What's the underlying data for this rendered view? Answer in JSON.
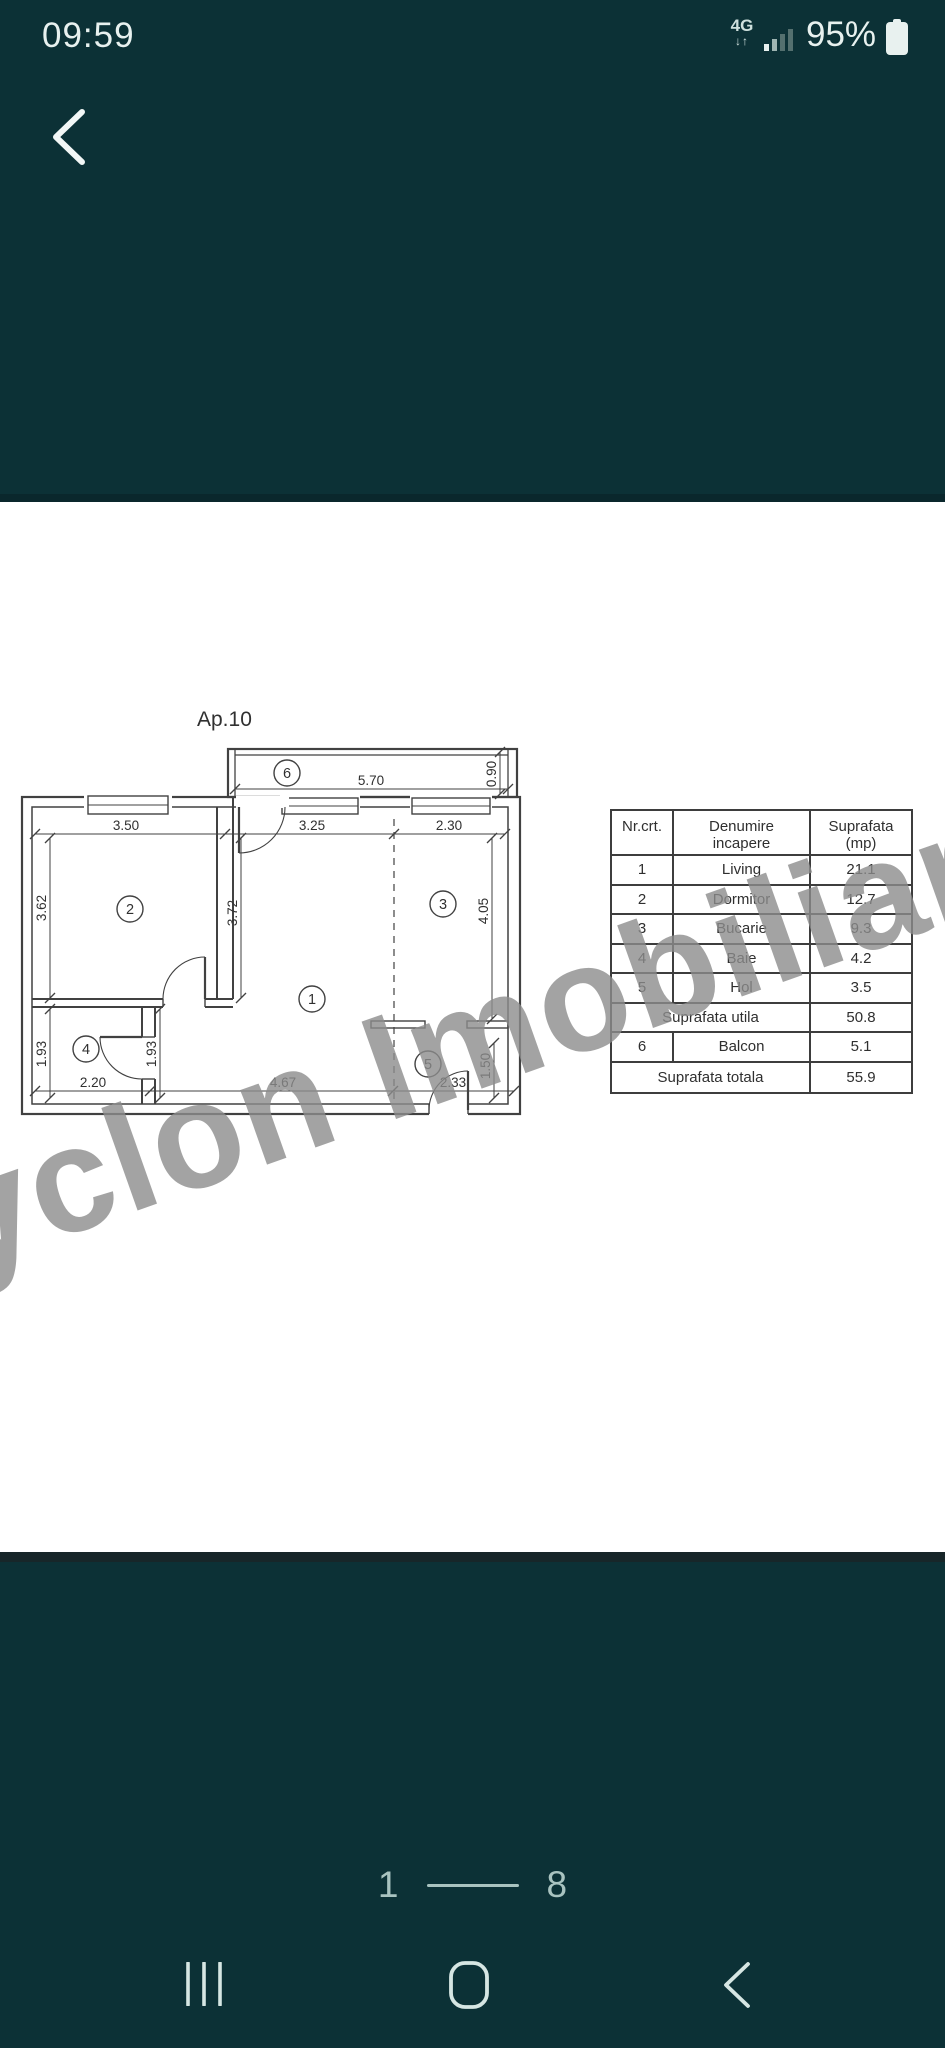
{
  "status_bar": {
    "time": "09:59",
    "network": "4G",
    "arrows": "↓↑",
    "battery_percent": "95%"
  },
  "photo": {
    "floor_plan": {
      "title": "Ap.10",
      "rooms": [
        "1",
        "2",
        "3",
        "4",
        "5",
        "6"
      ],
      "dims": {
        "balcony_width": "5.70",
        "balcony_depth": "0.90",
        "top_left": "3.50",
        "top_mid": "3.25",
        "top_right": "2.30",
        "left_upper": "3.62",
        "mid_vert": "3.72",
        "right_upper": "4.05",
        "left_lower": "1.93",
        "mid_lower": "1.93",
        "right_lower": "1.50",
        "bottom_left": "2.20",
        "bottom_mid": "4.67",
        "bottom_right": "2.33"
      }
    },
    "table": {
      "headers": {
        "col1": "Nr.crt.",
        "col2_line1": "Denumire",
        "col2_line2": "incapere",
        "col3_line1": "Suprafata",
        "col3_line2": "(mp)"
      },
      "rows": [
        {
          "nr": "1",
          "name": "Living",
          "area": "21.1"
        },
        {
          "nr": "2",
          "name": "Dormitor",
          "area": "12.7"
        },
        {
          "nr": "3",
          "name": "Bucarie",
          "area": "9.3"
        },
        {
          "nr": "4",
          "name": "Baie",
          "area": "4.2"
        },
        {
          "nr": "5",
          "name": "Hol",
          "area": "3.5"
        },
        {
          "nr": "",
          "name": "Suprafata utila",
          "area": "50.8"
        },
        {
          "nr": "6",
          "name": "Balcon",
          "area": "5.1"
        },
        {
          "nr": "",
          "name": "Suprafata totala",
          "area": "55.9"
        }
      ]
    },
    "watermark": "Cyclon Imobiliare"
  },
  "pagination": {
    "current": "1",
    "total": "8"
  },
  "colors": {
    "background": "#0c3136",
    "photo_bg": "#ffffff",
    "plan_line": "#414141",
    "watermark": "#8c8c8c",
    "icon": "#d6e6e3",
    "status_text": "#e8f1ef"
  }
}
